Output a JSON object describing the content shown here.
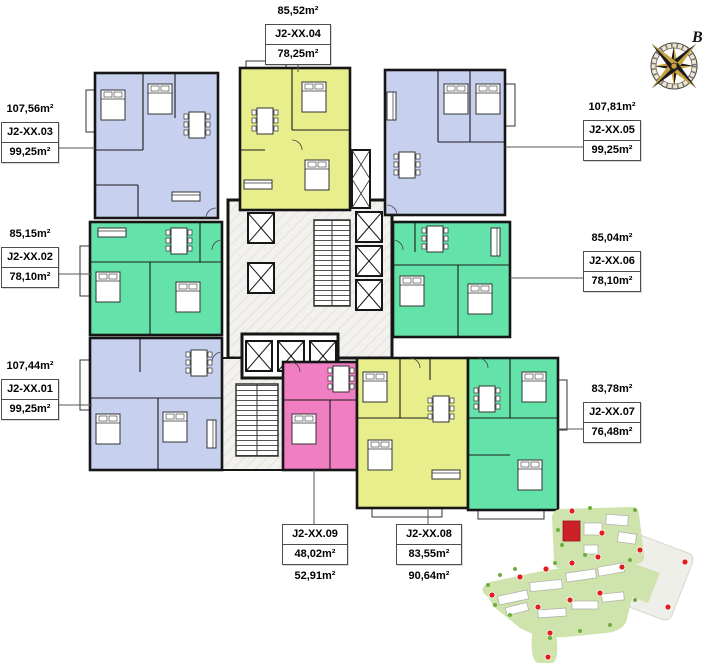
{
  "colors": {
    "lavender": "#c8d0ef",
    "green": "#63e3aa",
    "yellow": "#e7ee8b",
    "pink": "#f07ec2",
    "wall": "#161616",
    "site_green": "#cfe3ad",
    "site_red": "#cc2127"
  },
  "compass": {
    "label": "B"
  },
  "units": [
    {
      "code": "J2-XX.01",
      "outer_area": "107,44m²",
      "box_area": "99,25m²"
    },
    {
      "code": "J2-XX.02",
      "outer_area": "85,15m²",
      "box_area": "78,10m²"
    },
    {
      "code": "J2-XX.03",
      "outer_area": "107,56m²",
      "box_area": "99,25m²"
    },
    {
      "code": "J2-XX.04",
      "outer_area": "85,52m²",
      "box_area": "78,25m²"
    },
    {
      "code": "J2-XX.05",
      "outer_area": "107,81m²",
      "box_area": "99,25m²"
    },
    {
      "code": "J2-XX.06",
      "outer_area": "85,04m²",
      "box_area": "78,10m²"
    },
    {
      "code": "J2-XX.07",
      "outer_area": "83,78m²",
      "box_area": "76,48m²"
    },
    {
      "code": "J2-XX.08",
      "outer_area": "90,64m²",
      "box_area": "83,55m²"
    },
    {
      "code": "J2-XX.09",
      "outer_area": "52,91m²",
      "box_area": "48,02m²"
    }
  ]
}
